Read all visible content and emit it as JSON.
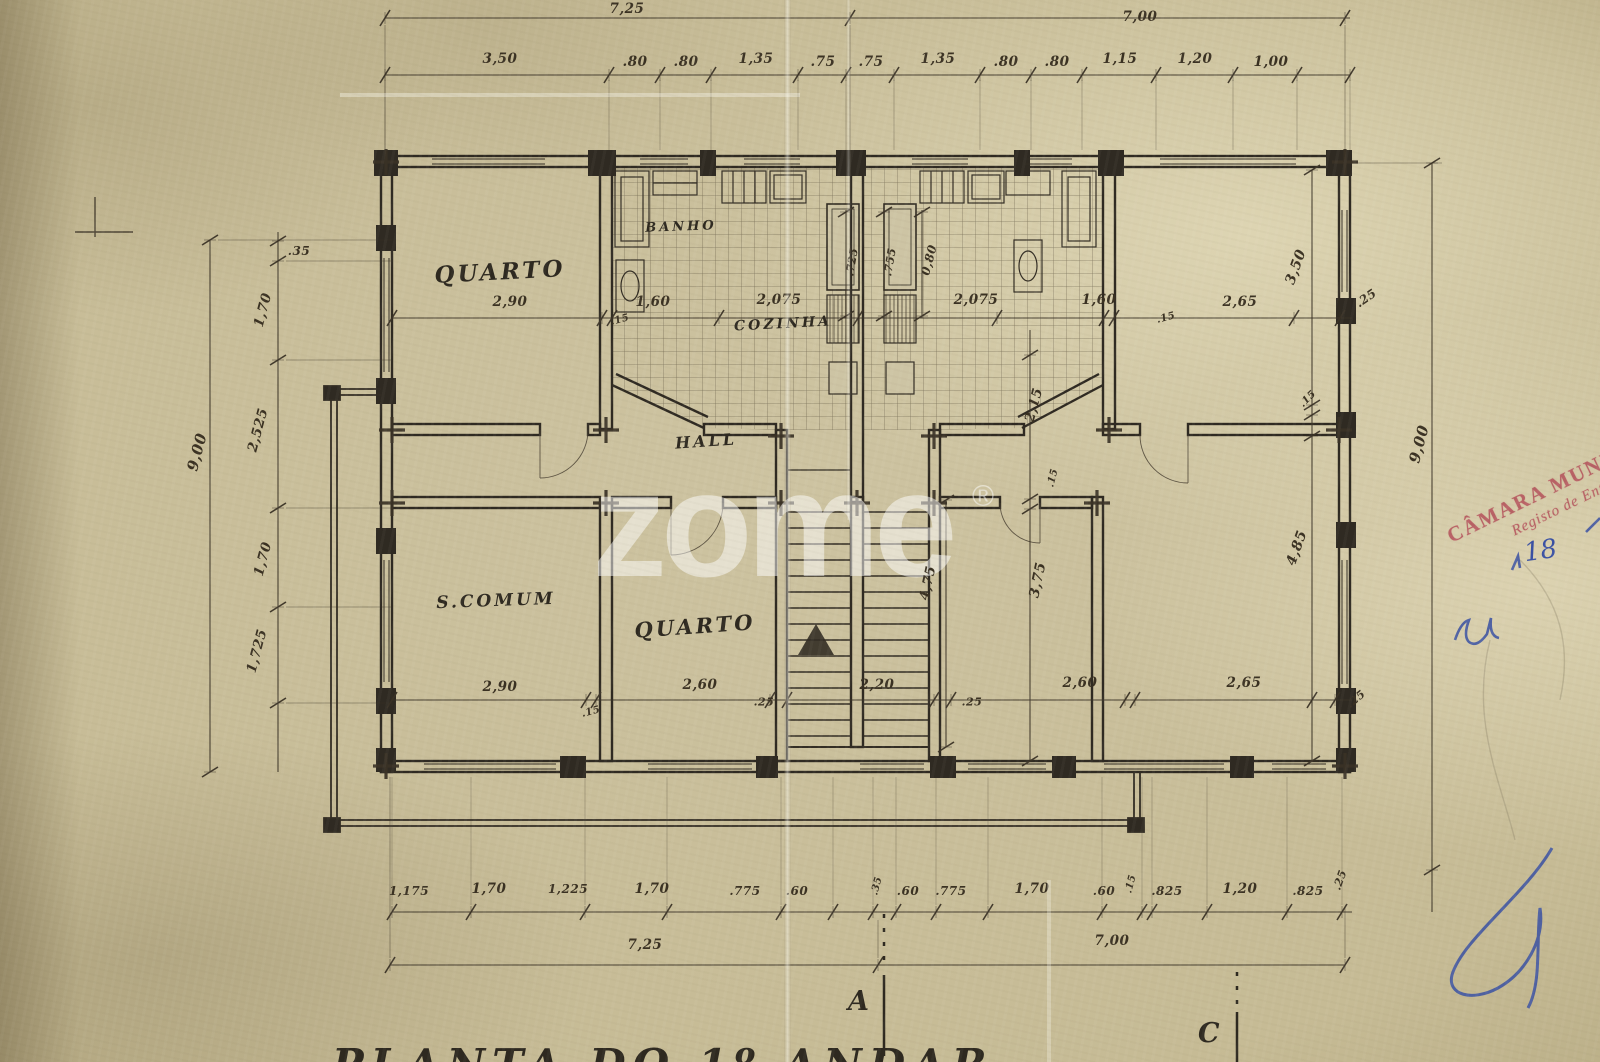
{
  "watermark": {
    "text": "zome",
    "registered": "®"
  },
  "stamp": {
    "line1": "CÂMARA MUNICIPAL",
    "line2": "Registo de Entrada"
  },
  "handwriting": {
    "number": "18"
  },
  "title": {
    "text": "PLANTA DO 1º ANDAR"
  },
  "section_markers": {
    "a": "A",
    "c": "C"
  },
  "colors": {
    "paper": "#c9bf9e",
    "ink": "#332d24",
    "stamp_red": "#b4505a",
    "pen_blue": "#3a51a3",
    "watermark": "#ffffff"
  },
  "plan": {
    "rooms": [
      {
        "label": "QUARTO",
        "x": 500,
        "y": 272,
        "s": 23,
        "r": -3
      },
      {
        "label": "BANHO",
        "x": 681,
        "y": 227,
        "s": 13,
        "r": -2
      },
      {
        "label": "COZINHA",
        "x": 783,
        "y": 324,
        "s": 14,
        "r": -3
      },
      {
        "label": "HALL",
        "x": 706,
        "y": 441,
        "s": 16,
        "r": -4
      },
      {
        "label": "S.COMUM",
        "x": 496,
        "y": 601,
        "s": 17,
        "r": -2
      },
      {
        "label": "QUARTO",
        "x": 695,
        "y": 626,
        "s": 21,
        "r": -4
      }
    ],
    "dimensions": [
      {
        "t": "7,25",
        "x": 627,
        "y": 9
      },
      {
        "t": "7,00",
        "x": 1140,
        "y": 17
      },
      {
        "t": "3,50",
        "x": 500,
        "y": 59
      },
      {
        "t": ".80",
        "x": 635,
        "y": 62
      },
      {
        "t": ".80",
        "x": 686,
        "y": 62
      },
      {
        "t": "1,35",
        "x": 756,
        "y": 59
      },
      {
        "t": ".75",
        "x": 823,
        "y": 62
      },
      {
        "t": ".75",
        "x": 871,
        "y": 62
      },
      {
        "t": "1,35",
        "x": 938,
        "y": 59
      },
      {
        "t": ".80",
        "x": 1006,
        "y": 62
      },
      {
        "t": ".80",
        "x": 1057,
        "y": 62
      },
      {
        "t": "1,15",
        "x": 1120,
        "y": 59
      },
      {
        "t": "1,20",
        "x": 1195,
        "y": 59
      },
      {
        "t": "1,00",
        "x": 1271,
        "y": 62
      },
      {
        "t": ".35",
        "x": 299,
        "y": 251,
        "s": 12
      },
      {
        "t": "1,70",
        "x": 263,
        "y": 310,
        "r": -75
      },
      {
        "t": "2,525",
        "x": 258,
        "y": 430,
        "r": -75
      },
      {
        "t": "1,70",
        "x": 263,
        "y": 559,
        "r": -75
      },
      {
        "t": "1,725",
        "x": 257,
        "y": 651,
        "r": -75
      },
      {
        "t": "9,00",
        "x": 197,
        "y": 452,
        "r": -75,
        "s": 15
      },
      {
        "t": "2,90",
        "x": 510,
        "y": 302
      },
      {
        "t": ".15",
        "x": 620,
        "y": 320,
        "s": 10,
        "r": -15
      },
      {
        "t": "1,60",
        "x": 653,
        "y": 302
      },
      {
        "t": "2,075",
        "x": 779,
        "y": 300
      },
      {
        "t": "2,075",
        "x": 976,
        "y": 300
      },
      {
        "t": "1,60",
        "x": 1099,
        "y": 300
      },
      {
        "t": ".15",
        "x": 1166,
        "y": 318,
        "s": 10,
        "r": -15
      },
      {
        "t": "2,65",
        "x": 1240,
        "y": 302
      },
      {
        "t": ".25",
        "x": 1366,
        "y": 298,
        "r": -35,
        "s": 12
      },
      {
        "t": ".725",
        "x": 852,
        "y": 262,
        "r": -80,
        "s": 11
      },
      {
        "t": ".755",
        "x": 890,
        "y": 262,
        "r": -80,
        "s": 11
      },
      {
        "t": "0,80",
        "x": 929,
        "y": 260,
        "r": -75,
        "s": 12
      },
      {
        "t": "3,50",
        "x": 1296,
        "y": 267,
        "r": -70,
        "s": 14
      },
      {
        "t": "2,15",
        "x": 1034,
        "y": 405,
        "r": -75
      },
      {
        "t": ".15",
        "x": 1053,
        "y": 478,
        "r": -75,
        "s": 10
      },
      {
        "t": ".15",
        "x": 1308,
        "y": 399,
        "r": -45,
        "s": 10
      },
      {
        "t": "3,75",
        "x": 1038,
        "y": 580,
        "r": -78,
        "s": 14
      },
      {
        "t": "4,85",
        "x": 1297,
        "y": 548,
        "r": -70,
        "s": 14
      },
      {
        "t": "9,00",
        "x": 1419,
        "y": 444,
        "r": -75,
        "s": 15
      },
      {
        "t": "4,75",
        "x": 928,
        "y": 583,
        "r": -78
      },
      {
        "t": "2,90",
        "x": 500,
        "y": 687
      },
      {
        "t": ".15",
        "x": 591,
        "y": 712,
        "s": 10,
        "r": -15
      },
      {
        "t": "2,60",
        "x": 700,
        "y": 685
      },
      {
        "t": ".25",
        "x": 764,
        "y": 702,
        "s": 11
      },
      {
        "t": "2,20",
        "x": 877,
        "y": 685
      },
      {
        "t": ".25",
        "x": 972,
        "y": 702,
        "s": 11
      },
      {
        "t": "2,60",
        "x": 1080,
        "y": 683
      },
      {
        "t": "2,65",
        "x": 1244,
        "y": 683
      },
      {
        "t": ".25",
        "x": 1356,
        "y": 699,
        "r": -40,
        "s": 11
      },
      {
        "t": "1,175",
        "x": 409,
        "y": 891,
        "s": 12
      },
      {
        "t": "1,70",
        "x": 489,
        "y": 889
      },
      {
        "t": "1,225",
        "x": 568,
        "y": 889,
        "s": 12
      },
      {
        "t": "1,70",
        "x": 652,
        "y": 889
      },
      {
        "t": ".775",
        "x": 745,
        "y": 891,
        "s": 12
      },
      {
        "t": ".60",
        "x": 797,
        "y": 891,
        "s": 12
      },
      {
        "t": ".35",
        "x": 877,
        "y": 886,
        "r": -75,
        "s": 10
      },
      {
        "t": ".60",
        "x": 908,
        "y": 891,
        "s": 12
      },
      {
        "t": ".775",
        "x": 951,
        "y": 891,
        "s": 12
      },
      {
        "t": "1,70",
        "x": 1032,
        "y": 889
      },
      {
        "t": ".60",
        "x": 1104,
        "y": 891,
        "s": 12
      },
      {
        "t": ".15",
        "x": 1131,
        "y": 884,
        "r": -75,
        "s": 10
      },
      {
        "t": ".825",
        "x": 1167,
        "y": 891,
        "s": 12
      },
      {
        "t": "1,20",
        "x": 1240,
        "y": 889
      },
      {
        "t": ".825",
        "x": 1308,
        "y": 891,
        "s": 12
      },
      {
        "t": ".25",
        "x": 1340,
        "y": 880,
        "r": -70,
        "s": 11
      },
      {
        "t": "7,25",
        "x": 645,
        "y": 945
      },
      {
        "t": "7,00",
        "x": 1112,
        "y": 941
      }
    ]
  }
}
